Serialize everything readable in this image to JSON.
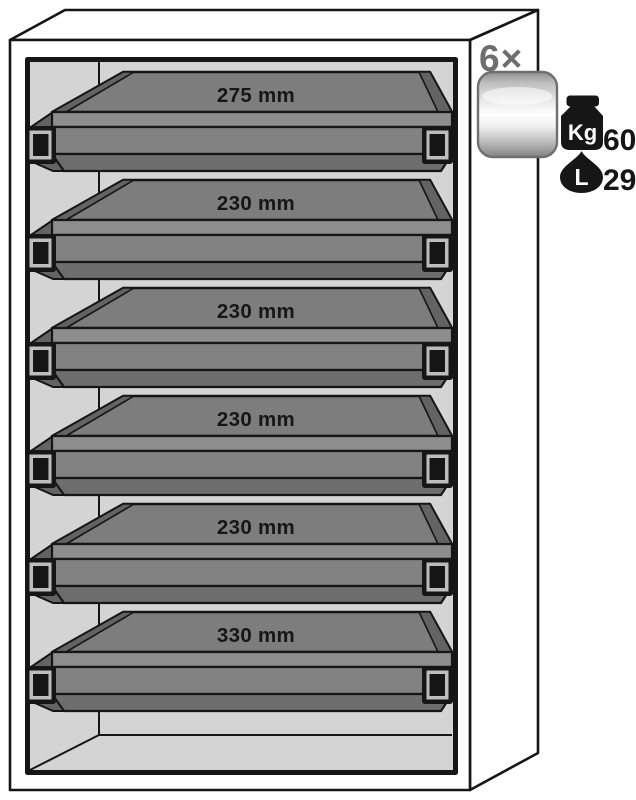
{
  "figure": {
    "quantity_label": "6×",
    "trays": [
      {
        "label": "275 mm"
      },
      {
        "label": "230 mm"
      },
      {
        "label": "230 mm"
      },
      {
        "label": "230 mm"
      },
      {
        "label": "230 mm"
      },
      {
        "label": "330 mm"
      }
    ],
    "specs": {
      "weight": {
        "icon": "kettlebell-weight-icon",
        "unit": "Kg",
        "value": "60"
      },
      "volume": {
        "icon": "liquid-drop-icon",
        "unit": "L",
        "value": "29"
      }
    },
    "icons": {
      "drawer": "metal-drawer-icon"
    },
    "colors": {
      "outline": "#161616",
      "cabinet_face": "#ffffff",
      "interior": "#d4d4d4",
      "tray_top": "#7d7d7d",
      "tray_rim": "#8d8d8d",
      "tray_front": "#828282",
      "tray_bevel": "#6d6d6d",
      "tray_shadow": "#636363",
      "handle_trim": "#bdbdbd",
      "quantity_gray": "#6e6e6e",
      "icon_black": "#161616"
    }
  }
}
